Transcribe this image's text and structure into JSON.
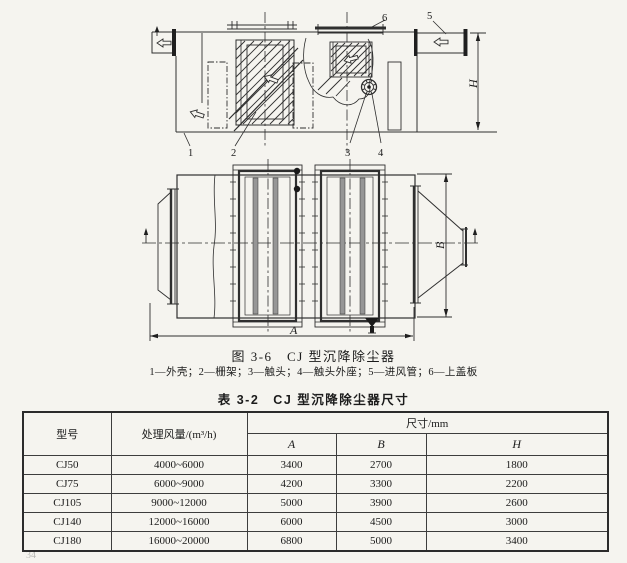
{
  "figure": {
    "callouts": {
      "n1": "1",
      "n2": "2",
      "n3": "3",
      "n4": "4",
      "n5": "5",
      "n6": "6"
    },
    "dims": {
      "A": "A",
      "B": "B",
      "H": "H"
    }
  },
  "fig_caption": "图 3-6　CJ 型沉降除尘器",
  "parts_line": "1—外壳；2—栅架；3—触头；4—触头外座；5—进风管；6—上盖板",
  "table_title": "表 3-2　CJ 型沉降除尘器尺寸",
  "table": {
    "col_model": "型号",
    "col_airflow": "处理风量/(m³/h)",
    "col_dims": "尺寸/mm",
    "sub_cols": [
      "A",
      "B",
      "H"
    ],
    "rows": [
      {
        "model": "CJ50",
        "airflow": "4000~6000",
        "A": "3400",
        "B": "2700",
        "H": "1800"
      },
      {
        "model": "CJ75",
        "airflow": "6000~9000",
        "A": "4200",
        "B": "3300",
        "H": "2200"
      },
      {
        "model": "CJ105",
        "airflow": "9000~12000",
        "A": "5000",
        "B": "3900",
        "H": "2600"
      },
      {
        "model": "CJ140",
        "airflow": "12000~16000",
        "A": "6000",
        "B": "4500",
        "H": "3000"
      },
      {
        "model": "CJ180",
        "airflow": "16000~20000",
        "A": "6800",
        "B": "5000",
        "H": "3400"
      }
    ]
  },
  "page_number": "34"
}
